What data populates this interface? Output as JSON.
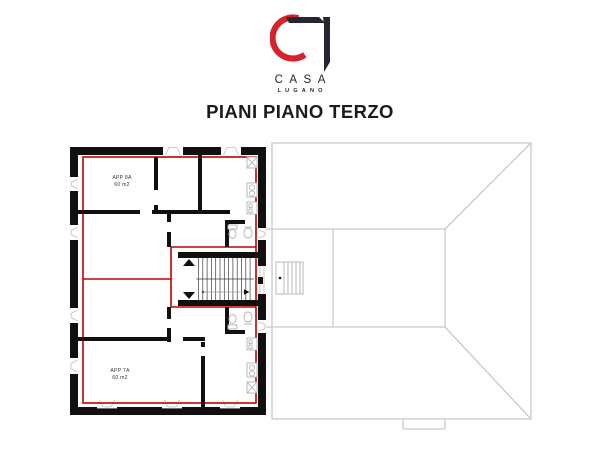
{
  "header": {
    "brand": "CASA",
    "brand_sub": "LUGANO",
    "title": "PIANI PIANO TERZO"
  },
  "floor_plan": {
    "apartment_top": {
      "name": "APP 8A",
      "area": "60 m2"
    },
    "apartment_bottom": {
      "name": "APP 7A",
      "area": "60 m2"
    }
  },
  "theme": {
    "wall": "#101010",
    "outline": "#c10000",
    "fixture": "#b3b3b3",
    "roof_line": "#c9c9c9",
    "logo_red": "#d5232b",
    "logo_dark": "#26262e",
    "ink": "#1b1b1d"
  }
}
